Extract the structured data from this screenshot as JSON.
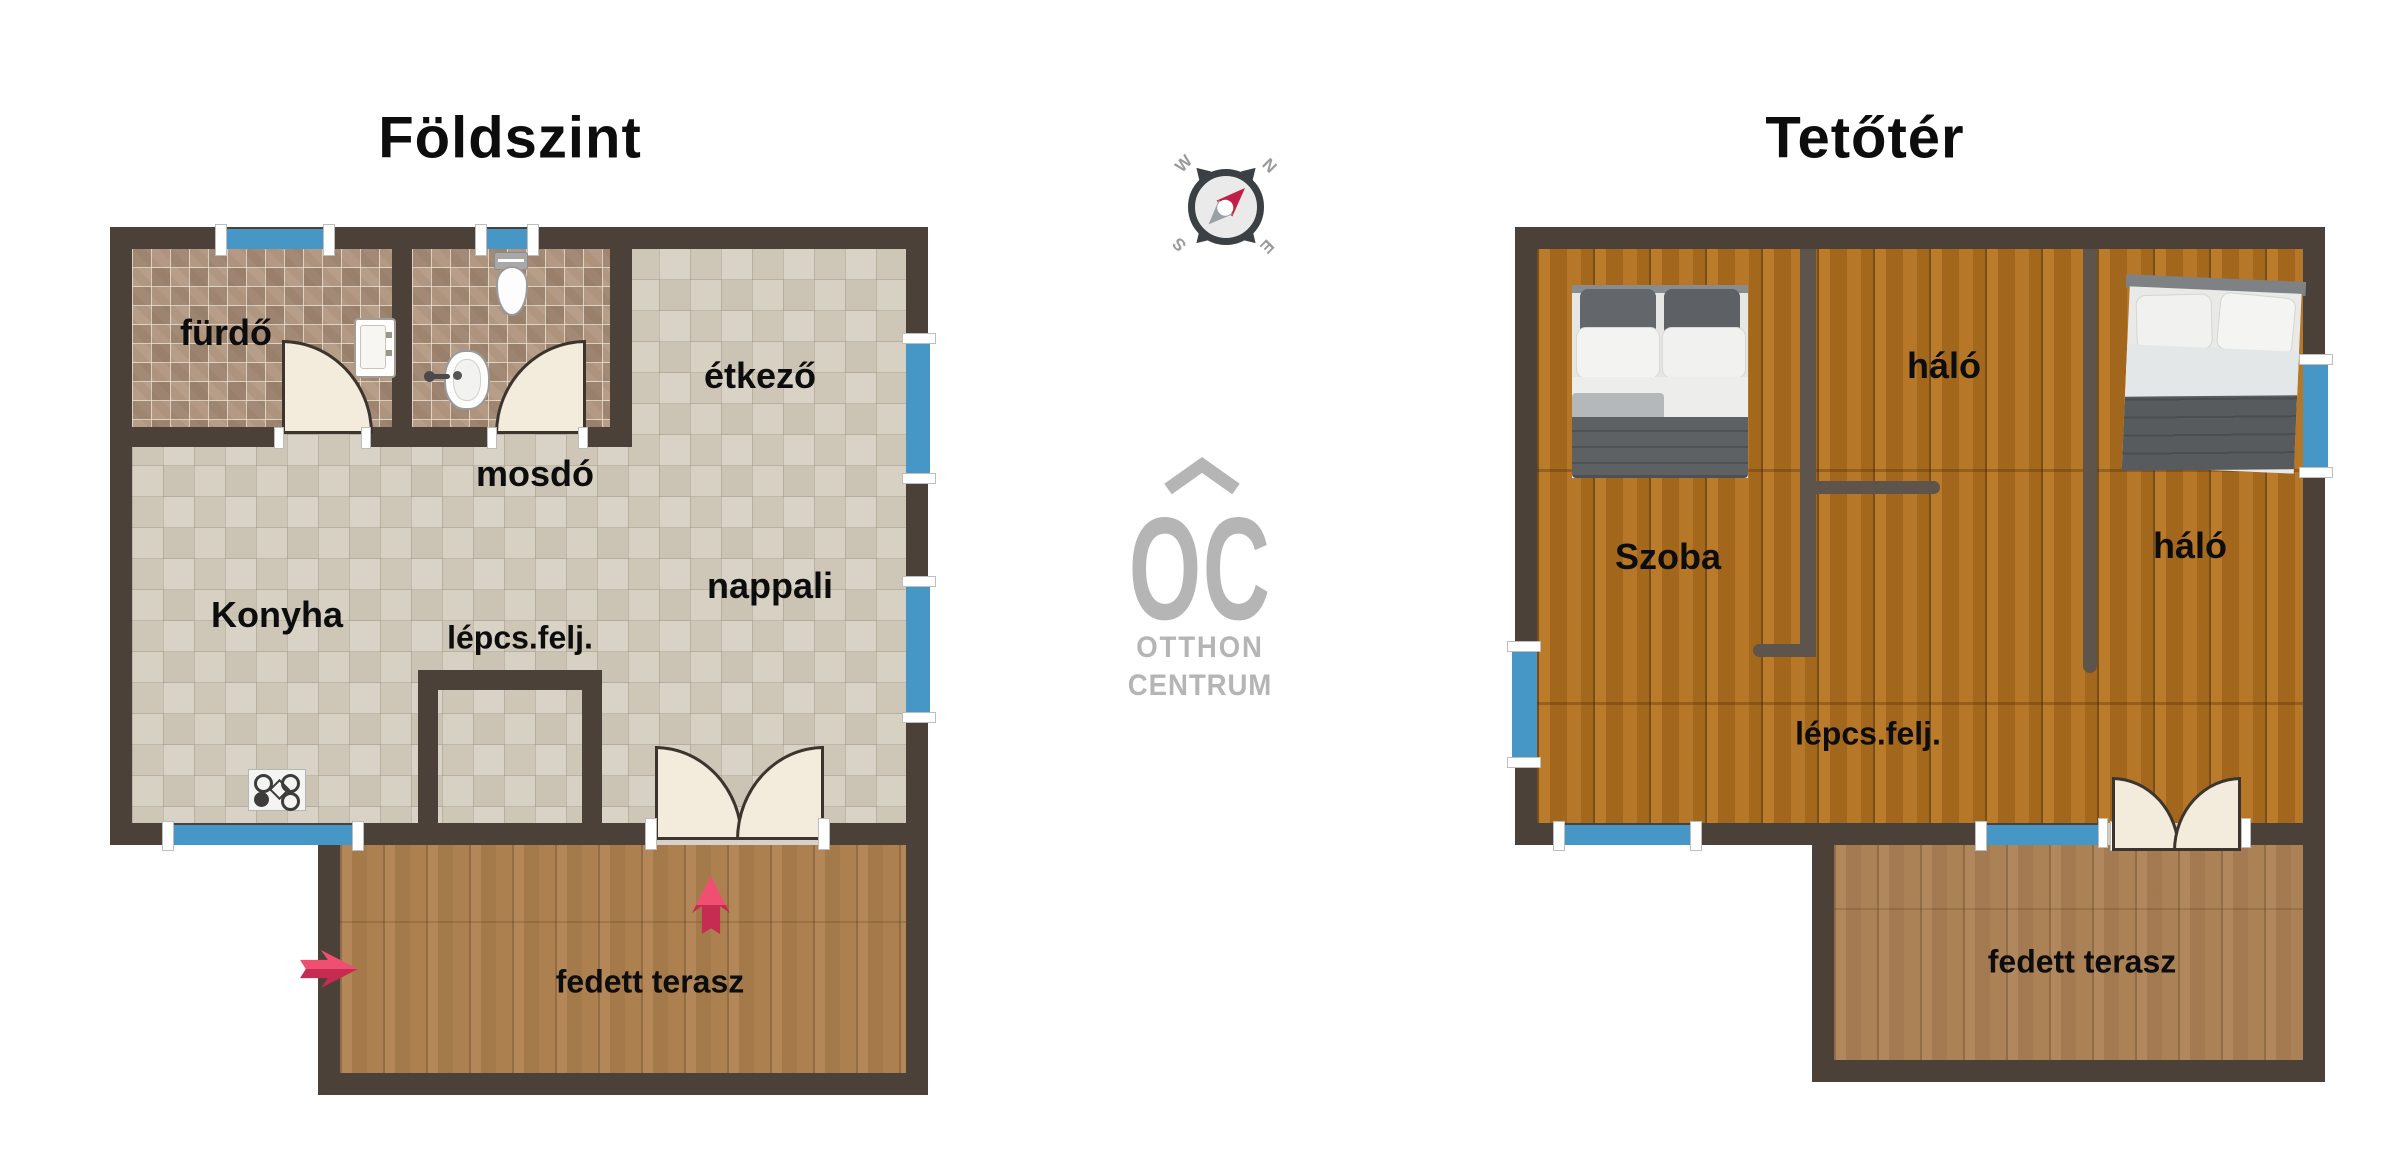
{
  "floor_ground": {
    "title": "Földszint",
    "labels": {
      "bathroom": "fürdő",
      "wc": "mosdó",
      "dining": "étkező",
      "kitchen": "Konyha",
      "stairs": "lépcs.felj.",
      "living": "nappali",
      "terrace": "fedett terasz"
    }
  },
  "floor_attic": {
    "title": "Tetőtér",
    "labels": {
      "room": "Szoba",
      "bedroom_center": "háló",
      "bedroom_right": "háló",
      "stairs": "lépcs.felj.",
      "terrace": "fedett terasz"
    }
  },
  "compass": {
    "n": "N",
    "e": "E",
    "s": "S",
    "w": "W"
  },
  "logo": {
    "monogram": "OC",
    "line1": "OTTHON",
    "line2": "CENTRUM"
  },
  "colors": {
    "wall": "#4b4138",
    "iwall": "#5d554b",
    "window": "#4697c6",
    "arrow-dark": "#c62b51",
    "arrow-light": "#ef5072",
    "logo": "#b5b5b5",
    "door": "#f3ecdc",
    "ink": "#0d0d0d"
  }
}
